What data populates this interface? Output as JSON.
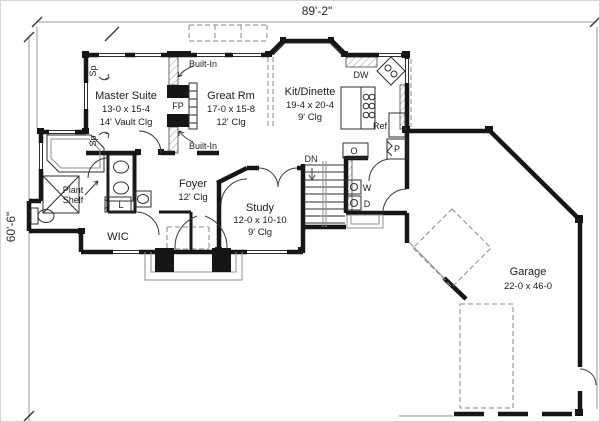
{
  "plan": {
    "dimensions": {
      "overall_width": "89'-2\"",
      "overall_height": "60'-6\""
    },
    "rooms": {
      "master": {
        "name": "Master Suite",
        "size": "13-0 x 15-4",
        "ceil": "14' Vault Clg"
      },
      "great": {
        "name": "Great Rm",
        "size": "17-0 x 15-8",
        "ceil": "12' Clg"
      },
      "kitchen": {
        "name": "Kit/Dinette",
        "size": "19-4 x 20-4",
        "ceil": "9' Clg"
      },
      "foyer": {
        "name": "Foyer",
        "ceil": "12' Clg"
      },
      "study": {
        "name": "Study",
        "size": "12-0 x 10-10",
        "ceil": "9' Clg"
      },
      "garage": {
        "name": "Garage",
        "size": "22-0 x 46-0"
      },
      "wic": {
        "name": "WIC"
      },
      "plant_shelf": {
        "line1": "Plant",
        "line2": "Shelf"
      }
    },
    "labels": {
      "built_in": "Built-In",
      "fireplace": "FP",
      "dishwasher": "DW",
      "refrigerator": "Ref",
      "stairs_down": "DN",
      "oven": "O",
      "pantry": "P",
      "washer": "W",
      "dryer": "D",
      "linen": "L",
      "speaker": "Sp"
    }
  }
}
